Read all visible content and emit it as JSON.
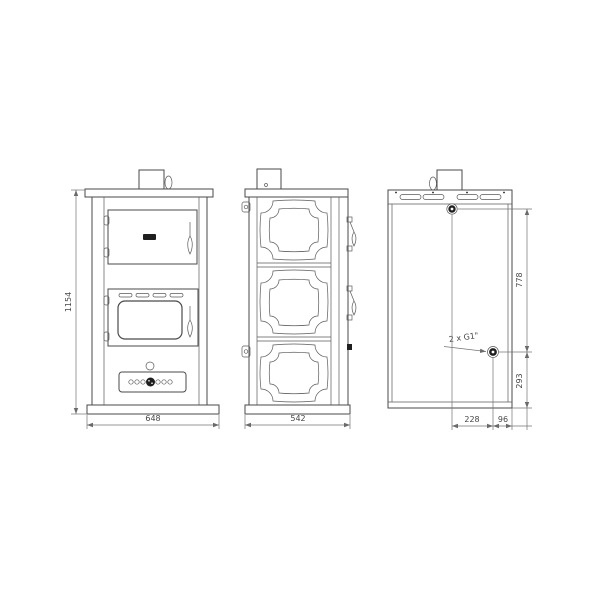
{
  "drawing": {
    "dimensions": {
      "overall_height_mm": "1154",
      "overall_width_mm": "648",
      "overall_depth_mm": "542",
      "connection_vertical_span_mm": "778",
      "lower_connection_height_mm": "293",
      "connection_horizontal_offset_mm": "228",
      "connection_edge_offset_mm": "96"
    },
    "annotations": {
      "boiler_connections": "2 x G1\""
    },
    "colors": {
      "line": "#4a4a4a",
      "dim_line": "#757575",
      "text": "#474747",
      "dark_fill": "#1f1f1f",
      "background": "#ffffff"
    }
  }
}
